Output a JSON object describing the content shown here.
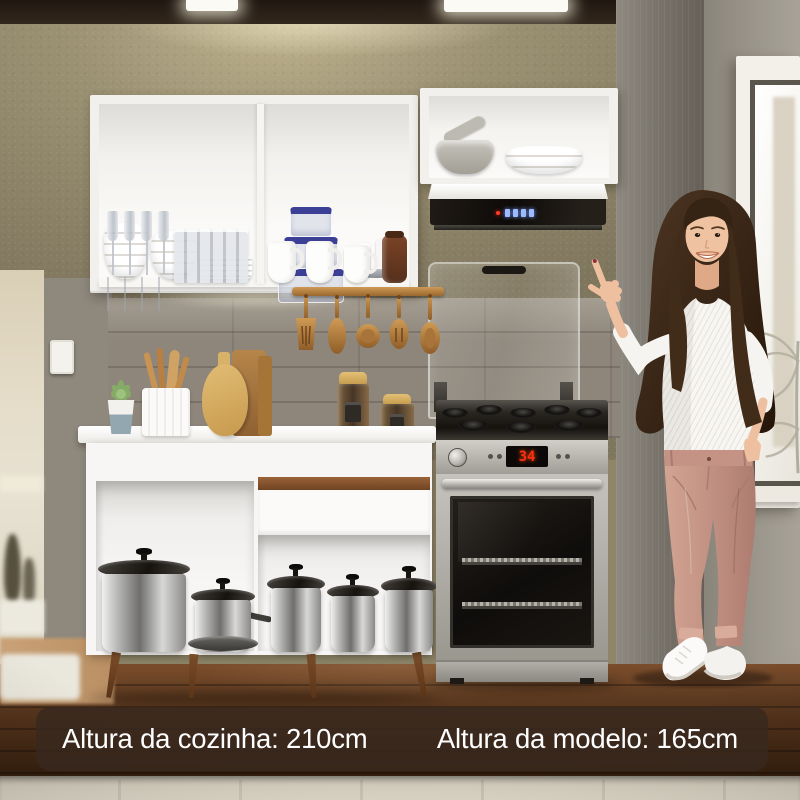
{
  "captions": {
    "kitchen_height": "Altura da cozinha: 210cm",
    "model_height": "Altura da modelo: 165cm"
  },
  "stove": {
    "display_value": "34"
  },
  "hood": {
    "led_count": 4
  },
  "colors": {
    "caption_bg": "rgba(56,40,30,0.82)",
    "caption_text": "#ffffff",
    "stove_led": "#ff2d12",
    "hood_led": "#9db9ff",
    "cabinet_white": "#f7f6f4",
    "drawer_handle_wood": "#8a5733",
    "wall_olive": "#8f8669",
    "wall_gray": "#736e66",
    "floor_wood": "#5b3921",
    "utensil_wood": "#c08946",
    "pants_rose": "#c29183"
  }
}
